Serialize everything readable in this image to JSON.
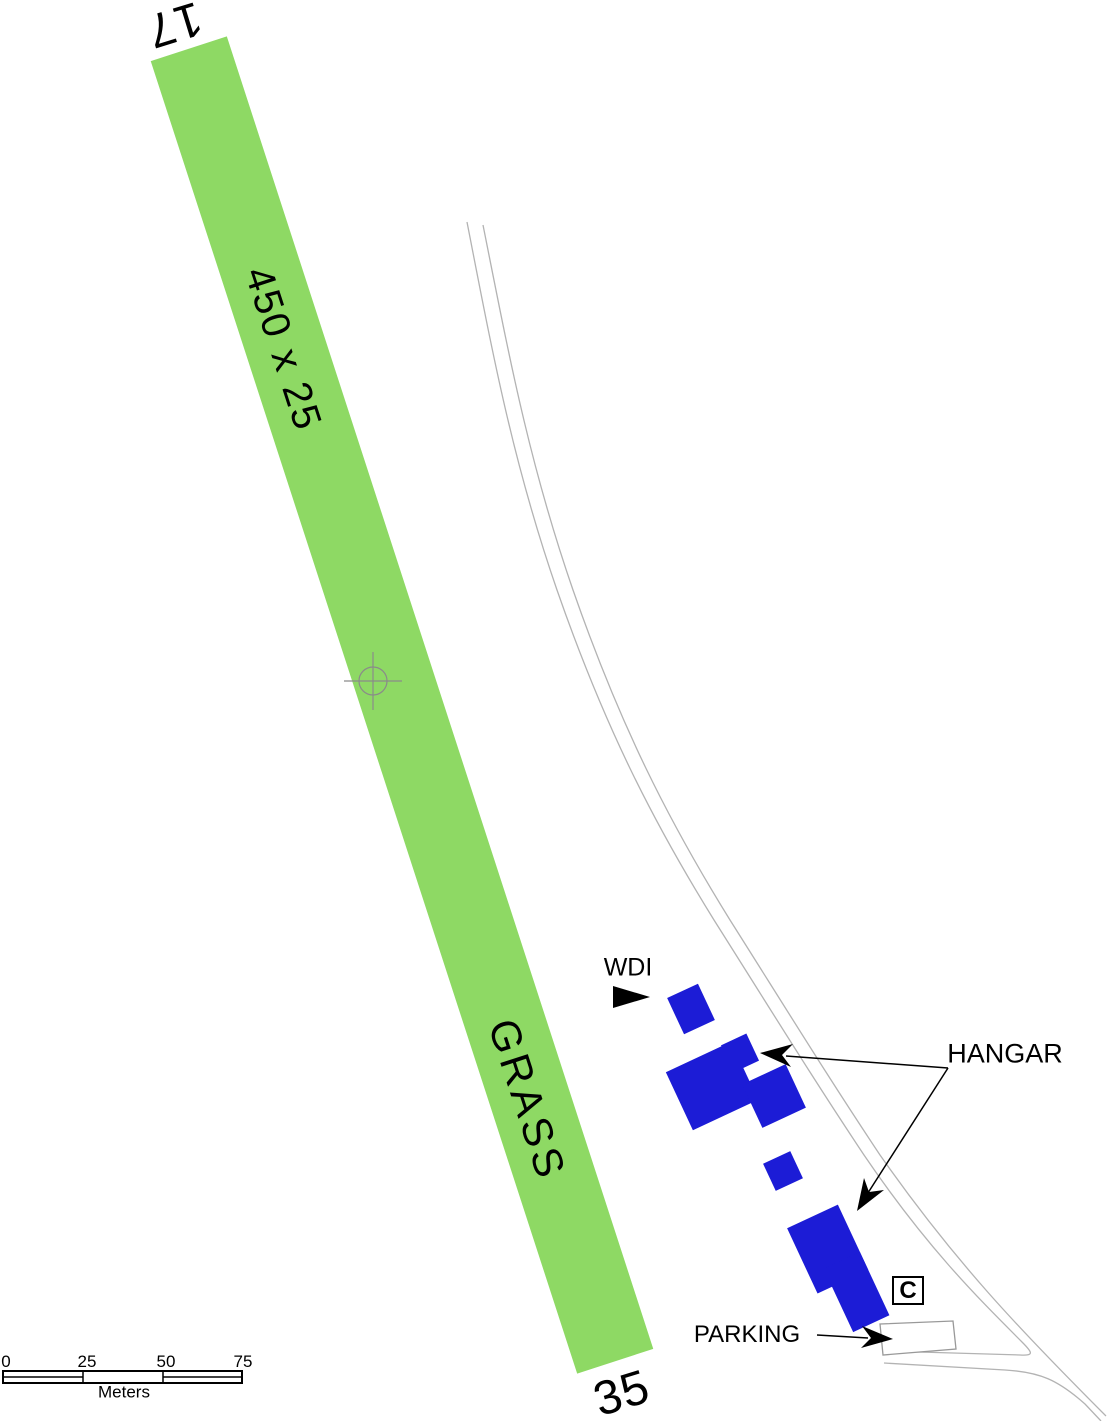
{
  "runway": {
    "top_number": "17",
    "bottom_number": "35",
    "size_label": "450 x 25",
    "surface_label": "GRASS"
  },
  "features": {
    "wdi_label": "WDI",
    "hangar_label": "HANGAR",
    "parking_label": "PARKING",
    "c_marker": "C"
  },
  "scale_bar": {
    "ticks": [
      "0",
      "25",
      "50",
      "75"
    ],
    "unit": "Meters"
  },
  "colors": {
    "runway_green": "#8ED964",
    "building_blue": "#1C1CD6",
    "road_gray": "#B3B3B3",
    "crosshair_gray": "#8A8A8A",
    "outline_gray": "#999999"
  }
}
